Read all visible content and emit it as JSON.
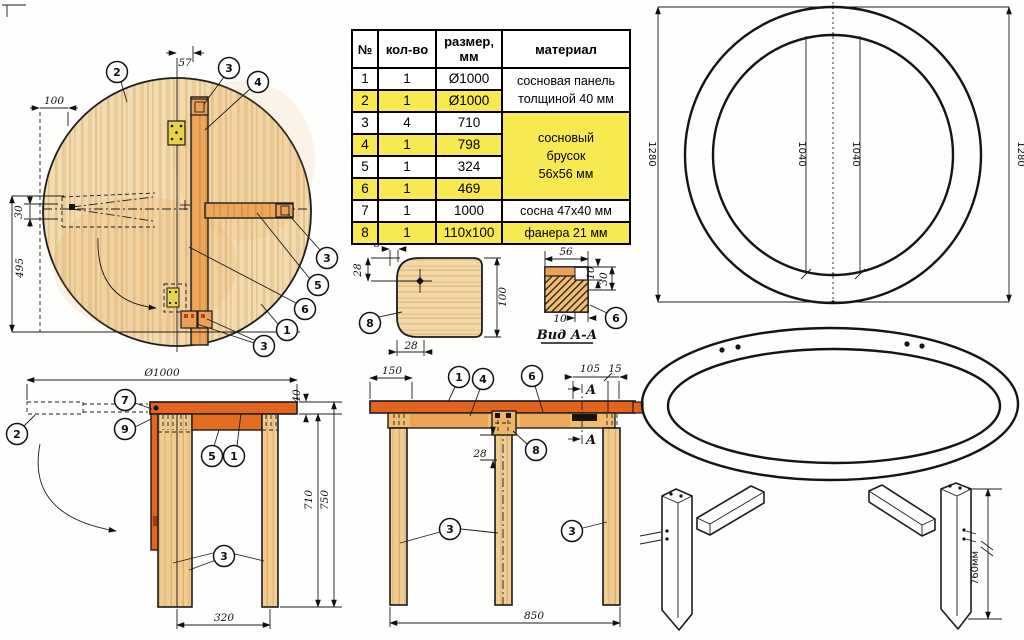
{
  "colors": {
    "tabletop_orange": "#E2641E",
    "wood_light": "#F2DBB0",
    "wood_bar": "#ECA75B",
    "leg_wood": "#F0CC93",
    "highlight_yellow": "#F7E94F",
    "hinge_yellow": "#E6D44C",
    "line": "#1C1C1C"
  },
  "parts_table": {
    "header_num": "№",
    "header_qty": "кол-во",
    "header_size_line1": "размер,",
    "header_size_line2": "мм",
    "header_material": "материал",
    "rows": [
      {
        "num": "1",
        "qty": "1",
        "size": "Ø1000"
      },
      {
        "num": "2",
        "qty": "1",
        "size": "Ø1000"
      },
      {
        "num": "3",
        "qty": "4",
        "size": "710"
      },
      {
        "num": "4",
        "qty": "1",
        "size": "798"
      },
      {
        "num": "5",
        "qty": "1",
        "size": "324"
      },
      {
        "num": "6",
        "qty": "1",
        "size": "469"
      },
      {
        "num": "7",
        "qty": "1",
        "size": "1000",
        "material": "сосна 47x40 мм"
      },
      {
        "num": "8",
        "qty": "1",
        "size": "110x100",
        "material": "фанера 21 мм"
      }
    ],
    "material_panel": [
      "сосновая панель",
      "толщиной 40 мм"
    ],
    "material_block": [
      "сосновый",
      "брусок",
      "56x56 мм"
    ]
  },
  "top_view": {
    "dim_57": "57",
    "dim_100": "100",
    "dim_30": "30",
    "dim_495": "495",
    "callout_2": "2",
    "callout_3_top": "3",
    "callout_4": "4",
    "callout_3_right": "3",
    "callout_5": "5",
    "callout_6": "6",
    "callout_1": "1",
    "callout_3_bottom": "3"
  },
  "ring_view": {
    "dim_height_left": "1280",
    "dim_height_right": "1280",
    "dim_inner_left": "1040",
    "dim_inner_right": "1040"
  },
  "detail_8": {
    "dim_hole_offset": "8",
    "dim_corner_v": "28",
    "dim_height": "100",
    "dim_corner_h": "28",
    "callout": "8"
  },
  "section_aa": {
    "label": "Вид А-А",
    "dim_width": "56",
    "dim_lip": "10",
    "dim_height": "30",
    "dim_notch": "10",
    "callout": "6"
  },
  "side_view": {
    "dim_diameter": "Ø1000",
    "dim_top": "40",
    "dim_leg": "710",
    "dim_total": "750",
    "dim_span": "320",
    "callout_7": "7",
    "callout_9": "9",
    "callout_2": "2",
    "callout_5": "5",
    "callout_1": "1",
    "callout_3": "3"
  },
  "front_view": {
    "dim_150": "150",
    "dim_105": "105",
    "dim_15": "15",
    "dim_28": "28",
    "dim_850": "850",
    "callout_1": "1",
    "callout_4": "4",
    "callout_6": "6",
    "callout_8": "8",
    "callout_3_left": "3",
    "callout_3_right": "3",
    "section_mark_top": "A",
    "section_mark_bottom": "A"
  },
  "perspective": {
    "dim_leg_height": "760мм"
  }
}
